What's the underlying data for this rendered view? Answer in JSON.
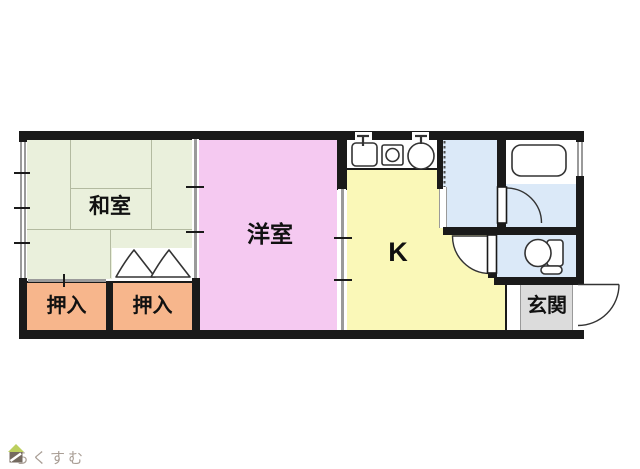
{
  "floorplan": {
    "rooms": {
      "washitsu": {
        "label": "和室",
        "color": "#eaf0dc"
      },
      "oshiire_left": {
        "label": "押入",
        "color": "#f7b68c"
      },
      "oshiire_right": {
        "label": "押入",
        "color": "#f7b68c"
      },
      "yoshitsu": {
        "label": "洋室",
        "color": "#f5c9f1"
      },
      "kitchen": {
        "label": "K",
        "color": "#faf8b8"
      },
      "washroom": {
        "color": "#dbe9f8"
      },
      "bathroom": {
        "color": "#dbe9f8"
      },
      "toilet": {
        "color": "#dbe9f8"
      },
      "genkan": {
        "label": "玄関",
        "color": "#dcdcdc"
      }
    },
    "wall_color": "#1a1a1a",
    "fixtures": [
      "kitchen-sink-icon",
      "gas-stove-icon",
      "wash-basin-icon",
      "bathtub-icon",
      "toilet-bowl-icon",
      "entrance-door-swing",
      "bathroom-door-swing",
      "toilet-door-swing",
      "accordion-door",
      "sliding-door-washitsu-yoshitsu",
      "sliding-door-yoshitsu-kitchen",
      "closet-sliding-door",
      "closet-bifold-door",
      "window-left",
      "window-bathroom"
    ]
  },
  "branding": {
    "logo_text": "らくすむ",
    "logo_roof_color": "#bccf5e",
    "logo_body_color": "#746a60",
    "logo_text_color": "#a99e95"
  }
}
